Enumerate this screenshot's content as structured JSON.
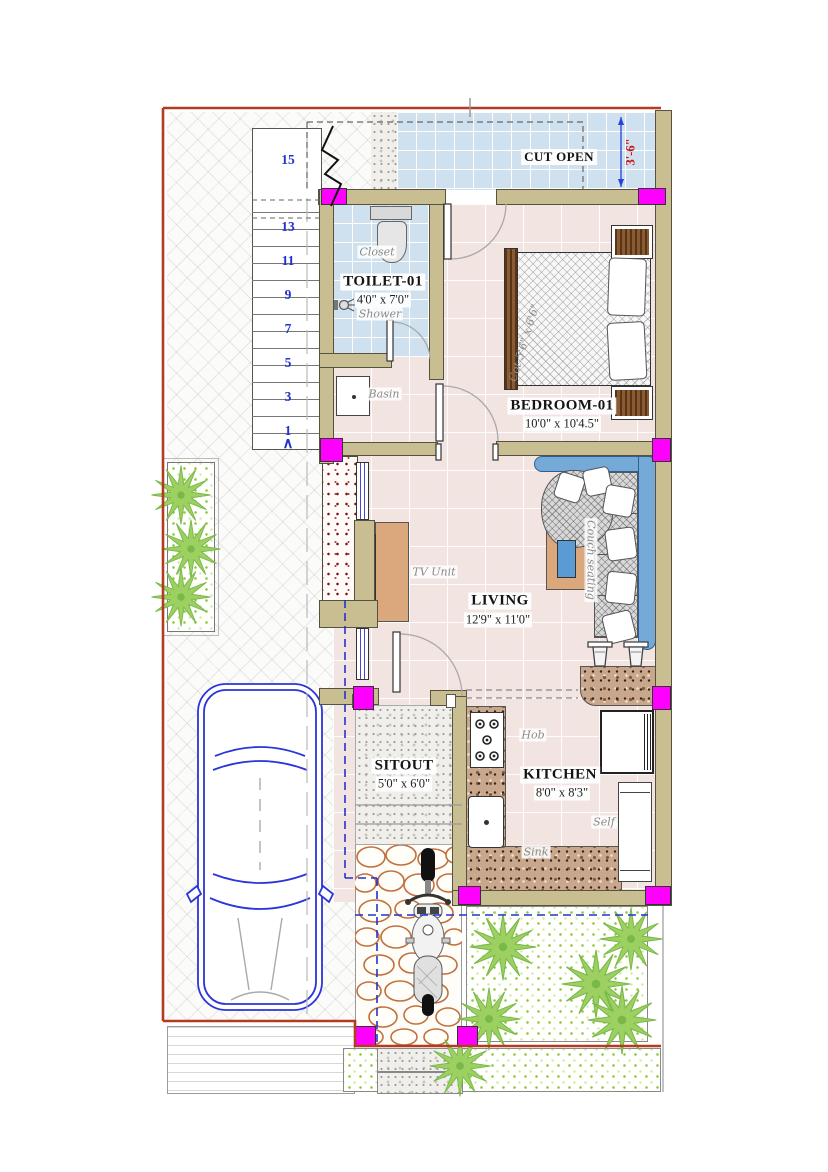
{
  "plan": {
    "title": "Ground floor plan",
    "cut_open": {
      "label": "CUT OPEN",
      "dim": "3'-6\""
    },
    "rooms": {
      "toilet": {
        "name": "TOILET-01",
        "dims": "4'0\" x 7'0\""
      },
      "bedroom": {
        "name": "BEDROOM-01",
        "dims": "10'0\" x 10'4.5\""
      },
      "living": {
        "name": "LIVING",
        "dims": "12'9\" x 11'0\""
      },
      "sitout": {
        "name": "SITOUT",
        "dims": "5'0\" x 6'0\""
      },
      "kitchen": {
        "name": "KITCHEN",
        "dims": "8'0\" x 8'3\""
      }
    },
    "fixtures": {
      "closet": "Closet",
      "shower": "Shower",
      "basin": "Basin",
      "tv_unit": "TV Unit",
      "couch": "Couch seating",
      "cot": "Cot 5'6\" x 6'6\"",
      "hob": "Hob",
      "sink": "Sink",
      "shelf": "Self"
    },
    "stairs": {
      "numbers": [
        "15",
        "13",
        "11",
        "9",
        "7",
        "5",
        "3",
        "1"
      ],
      "up_arrow": "∧"
    },
    "colors": {
      "wall": "#c9bd92",
      "column": "#ff00ff",
      "tile_blue": "#cfe0ef",
      "floor_pink": "#f2e5e1",
      "boundary_red": "#b23b22",
      "couch_blue": "#74a9d8",
      "palm_green": "#9cd162",
      "dim_red": "#cc1111"
    }
  }
}
